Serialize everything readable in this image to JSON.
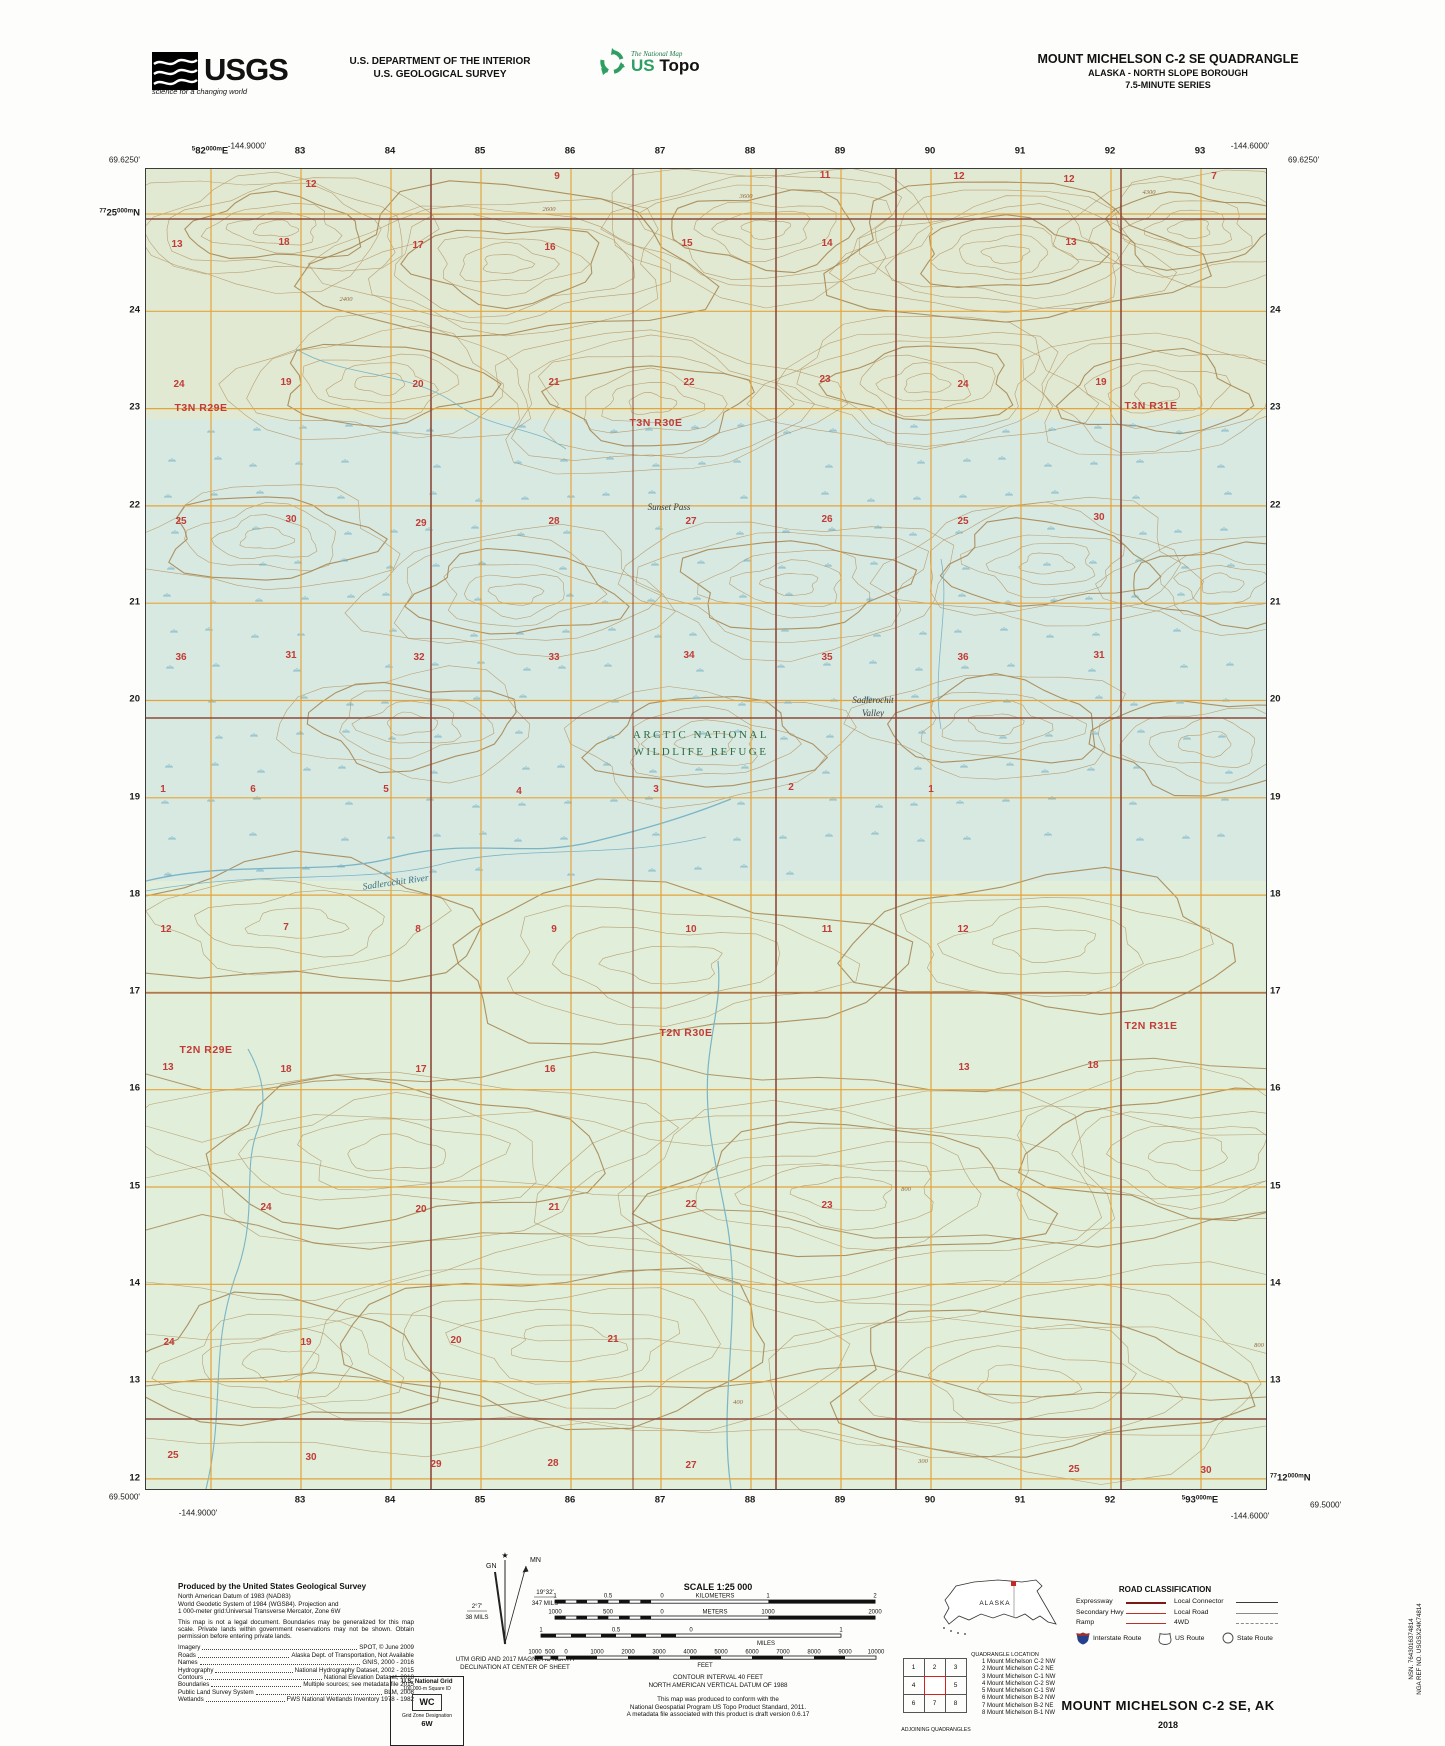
{
  "header": {
    "agency": "USGS",
    "agency_tagline": "science for a changing world",
    "dept_line1": "U.S. DEPARTMENT OF THE INTERIOR",
    "dept_line2": "U.S. GEOLOGICAL SURVEY",
    "program_small": "The National Map",
    "program_us": "US",
    "program_topo": "Topo",
    "quad_title": "MOUNT MICHELSON C-2 SE QUADRANGLE",
    "quad_subtitle": "ALASKA - NORTH SLOPE BOROUGH",
    "quad_series": "7.5-MINUTE SERIES"
  },
  "map": {
    "corner_coords": [
      {
        "t": "-144.9000'",
        "x": 247,
        "y": 146,
        "a": "c"
      },
      {
        "t": "69.6250'",
        "x": 140,
        "y": 160,
        "a": "r"
      },
      {
        "t": "-144.6000'",
        "x": 1250,
        "y": 146,
        "a": "c"
      },
      {
        "t": "69.6250'",
        "x": 1288,
        "y": 160,
        "a": "l"
      },
      {
        "t": "69.5000'",
        "x": 140,
        "y": 1497,
        "a": "r"
      },
      {
        "t": "-144.9000'",
        "x": 198,
        "y": 1513,
        "a": "c"
      },
      {
        "t": "-144.6000'",
        "x": 1250,
        "y": 1516,
        "a": "c"
      },
      {
        "t": "69.5000'",
        "x": 1310,
        "y": 1505,
        "a": "l"
      }
    ],
    "grid_full_labels": [
      {
        "x": 210,
        "y": 151,
        "pos": "c",
        "parts": [
          [
            "5",
            1
          ],
          [
            "82",
            0
          ],
          [
            "000m",
            1
          ],
          [
            "E",
            0
          ]
        ]
      },
      {
        "x": 140,
        "y": 213,
        "pos": "r",
        "parts": [
          [
            "77",
            1
          ],
          [
            "25",
            0
          ],
          [
            "000m",
            1
          ],
          [
            "N",
            0
          ]
        ]
      },
      {
        "x": 1200,
        "y": 1500,
        "pos": "c",
        "parts": [
          [
            "5",
            1
          ],
          [
            "93",
            0
          ],
          [
            "000m",
            1
          ],
          [
            "E",
            0
          ]
        ]
      },
      {
        "x": 1270,
        "y": 1478,
        "pos": "l",
        "parts": [
          [
            "77",
            1
          ],
          [
            "12",
            0
          ],
          [
            "000m",
            1
          ],
          [
            "N",
            0
          ]
        ]
      }
    ],
    "grid_top": [
      "83",
      "84",
      "85",
      "86",
      "87",
      "88",
      "89",
      "90",
      "91",
      "92",
      "93"
    ],
    "grid_bottom": [
      "83",
      "84",
      "85",
      "86",
      "87",
      "88",
      "89",
      "90",
      "91",
      "92"
    ],
    "grid_left": [
      "24",
      "23",
      "22",
      "21",
      "20",
      "19",
      "18",
      "17",
      "16",
      "15",
      "14",
      "13",
      "12"
    ],
    "grid_right": [
      "24",
      "23",
      "22",
      "21",
      "20",
      "19",
      "18",
      "17",
      "16",
      "15",
      "14",
      "13"
    ],
    "townships": [
      {
        "t": "T3N R29E",
        "x": 200,
        "y": 410
      },
      {
        "t": "T3N R30E",
        "x": 655,
        "y": 425
      },
      {
        "t": "T3N R31E",
        "x": 1150,
        "y": 408
      },
      {
        "t": "T2N R29E",
        "x": 205,
        "y": 1052
      },
      {
        "t": "T2N R30E",
        "x": 685,
        "y": 1035
      },
      {
        "t": "T2N R31E",
        "x": 1150,
        "y": 1028
      }
    ],
    "area_labels": {
      "refuge1": "ARCTIC NATIONAL",
      "refuge2": "WILDLIFE REFUGE",
      "pass": "Sunset Pass",
      "valley1": "Sadlerochit",
      "valley2": "Valley",
      "river": "Sadlerochit River"
    },
    "sections": [
      [
        310,
        186,
        "12"
      ],
      [
        556,
        178,
        "9"
      ],
      [
        824,
        177,
        "11"
      ],
      [
        958,
        178,
        "12"
      ],
      [
        1068,
        181,
        "12"
      ],
      [
        1213,
        178,
        "7"
      ],
      [
        176,
        246,
        "13"
      ],
      [
        283,
        244,
        "18"
      ],
      [
        417,
        247,
        "17"
      ],
      [
        549,
        249,
        "16"
      ],
      [
        686,
        245,
        "15"
      ],
      [
        826,
        245,
        "14"
      ],
      [
        1070,
        244,
        "13"
      ],
      [
        178,
        386,
        "24"
      ],
      [
        285,
        384,
        "19"
      ],
      [
        417,
        386,
        "20"
      ],
      [
        553,
        384,
        "21"
      ],
      [
        688,
        384,
        "22"
      ],
      [
        824,
        381,
        "23"
      ],
      [
        962,
        386,
        "24"
      ],
      [
        1100,
        384,
        "19"
      ],
      [
        180,
        523,
        "25"
      ],
      [
        290,
        521,
        "30"
      ],
      [
        420,
        525,
        "29"
      ],
      [
        553,
        523,
        "28"
      ],
      [
        690,
        523,
        "27"
      ],
      [
        826,
        521,
        "26"
      ],
      [
        962,
        523,
        "25"
      ],
      [
        1098,
        519,
        "30"
      ],
      [
        180,
        659,
        "36"
      ],
      [
        290,
        657,
        "31"
      ],
      [
        418,
        659,
        "32"
      ],
      [
        553,
        659,
        "33"
      ],
      [
        688,
        657,
        "34"
      ],
      [
        826,
        659,
        "35"
      ],
      [
        962,
        659,
        "36"
      ],
      [
        1098,
        657,
        "31"
      ],
      [
        162,
        791,
        "1"
      ],
      [
        252,
        791,
        "6"
      ],
      [
        385,
        791,
        "5"
      ],
      [
        518,
        793,
        "4"
      ],
      [
        655,
        791,
        "3"
      ],
      [
        790,
        789,
        "2"
      ],
      [
        930,
        791,
        "1"
      ],
      [
        165,
        931,
        "12"
      ],
      [
        285,
        929,
        "7"
      ],
      [
        417,
        931,
        "8"
      ],
      [
        553,
        931,
        "9"
      ],
      [
        690,
        931,
        "10"
      ],
      [
        826,
        931,
        "11"
      ],
      [
        962,
        931,
        "12"
      ],
      [
        167,
        1069,
        "13"
      ],
      [
        285,
        1071,
        "18"
      ],
      [
        420,
        1071,
        "17"
      ],
      [
        549,
        1071,
        "16"
      ],
      [
        963,
        1069,
        "13"
      ],
      [
        1092,
        1067,
        "18"
      ],
      [
        265,
        1209,
        "24"
      ],
      [
        420,
        1211,
        "20"
      ],
      [
        553,
        1209,
        "21"
      ],
      [
        690,
        1206,
        "22"
      ],
      [
        826,
        1207,
        "23"
      ],
      [
        168,
        1344,
        "24"
      ],
      [
        305,
        1344,
        "19"
      ],
      [
        455,
        1342,
        "20"
      ],
      [
        612,
        1341,
        "21"
      ],
      [
        172,
        1457,
        "25"
      ],
      [
        310,
        1459,
        "30"
      ],
      [
        435,
        1466,
        "29"
      ],
      [
        552,
        1465,
        "28"
      ],
      [
        690,
        1467,
        "27"
      ],
      [
        1073,
        1471,
        "25"
      ],
      [
        1205,
        1472,
        "30"
      ]
    ],
    "elevations": [
      [
        548,
        210,
        "2600"
      ],
      [
        745,
        197,
        "3600"
      ],
      [
        345,
        300,
        "2400"
      ],
      [
        1148,
        193,
        "4300"
      ],
      [
        905,
        1190,
        "800"
      ],
      [
        737,
        1403,
        "400"
      ],
      [
        922,
        1462,
        "300"
      ],
      [
        1258,
        1346,
        "800"
      ]
    ]
  },
  "footer": {
    "produced": {
      "heading": "Produced by the United States Geological Survey",
      "datum_lines": [
        "North American Datum of 1983 (NAD83)",
        "World Geodetic System of 1984 (WGS84).  Projection and",
        "1 000-meter grid:Universal Transverse Mercator, Zone 6W"
      ],
      "legal": "This map is not a legal document. Boundaries may be generalized for this map scale. Private lands within government reservations may not be shown. Obtain permission before entering private lands.",
      "credits": [
        [
          "Imagery",
          "SPOT,  ©  June  2009"
        ],
        [
          "Roads",
          "Alaska Dept. of Transportation, Not Available"
        ],
        [
          "Names",
          "GNIS, 2000 - 2016"
        ],
        [
          "Hydrography",
          "National Hydrography Dataset, 2002 - 2015"
        ],
        [
          "Contours",
          "National Elevation Dataset, 2018"
        ],
        [
          "Boundaries",
          "Multiple sources; see metadata file 2015"
        ],
        [
          "Public Land Survey System",
          "BLM, 2008"
        ],
        [
          "Wetlands",
          "FWS National Wetlands Inventory 1978 - 1982"
        ]
      ]
    },
    "declination": {
      "gn": "GN",
      "mn": "MN",
      "mn_deg": "19°32'",
      "mn_mils": "347 MILS",
      "gn_deg": "2°7'",
      "gn_mils": "38 MILS",
      "cap1": "UTM GRID AND 2017 MAGNETIC NORTH",
      "cap2": "DECLINATION AT CENTER OF SHEET"
    },
    "usng": {
      "title": "U.S. National Grid",
      "sq_label": "100,000-m Square ID",
      "square": "WC",
      "zone_label": "Grid Zone Designation",
      "zone": "6W"
    },
    "scale": {
      "title": "SCALE 1:25 000",
      "bars": [
        {
          "y": 10,
          "x": 60,
          "unit": 106.7,
          "subdiv": 10,
          "right": 2,
          "labels": [
            [
              "1",
              60
            ],
            [
              "0.5",
              113
            ],
            [
              "0",
              167
            ],
            [
              "KILOMETERS",
              220
            ],
            [
              "1",
              273
            ],
            [
              "2",
              380
            ]
          ]
        },
        {
          "y": 26,
          "x": 60,
          "unit": 106.7,
          "subdiv": 10,
          "right": 2,
          "labels": [
            [
              "1000",
              60
            ],
            [
              "500",
              113
            ],
            [
              "0",
              167
            ],
            [
              "METERS",
              220
            ],
            [
              "1000",
              273
            ],
            [
              "2000",
              380
            ]
          ]
        },
        {
          "y": 44,
          "x": 46,
          "unit": 150,
          "subdiv": 10,
          "right": 1,
          "labels": [
            [
              "1",
              46
            ],
            [
              "0.5",
              121
            ],
            [
              "0",
              196
            ],
            [
              "1",
              346
            ]
          ],
          "below": [
            "MILES",
            271
          ]
        },
        {
          "y": 66,
          "x": 40,
          "unit": 31,
          "subdiv": 4,
          "right": 10,
          "labels": [
            [
              "1000",
              40
            ],
            [
              "500",
              55
            ],
            [
              "0",
              71
            ],
            [
              "1000",
              102
            ],
            [
              "2000",
              133
            ],
            [
              "3000",
              164
            ],
            [
              "4000",
              195
            ],
            [
              "5000",
              226
            ],
            [
              "6000",
              257
            ],
            [
              "7000",
              288
            ],
            [
              "8000",
              319
            ],
            [
              "9000",
              350
            ],
            [
              "10000",
              381
            ]
          ],
          "below": [
            "FEET",
            210
          ]
        }
      ],
      "note1": "CONTOUR INTERVAL 40 FEET",
      "note2": "NORTH AMERICAN VERTICAL DATUM OF 1988",
      "conform": [
        "This map was produced to conform with the",
        "National Geospatial Program US Topo Product Standard, 2011.",
        "A metadata file associated with this product is draft version 0.6.17"
      ]
    },
    "inset": {
      "state": "ALASKA",
      "caption": "QUADRANGLE LOCATION"
    },
    "roads": {
      "title": "ROAD CLASSIFICATION",
      "rows": [
        {
          "l": "Expressway",
          "lw": 2.6,
          "lc": "#7a1a15",
          "r": "Local Connector",
          "rw": 1.4,
          "rc": "#3a3a3a",
          "rdash": 0
        },
        {
          "l": "Secondary Hwy",
          "lw": 1.6,
          "lc": "#b5332a",
          "r": "Local Road",
          "rw": 1.4,
          "rc": "#8a8a8a",
          "rdash": 0
        },
        {
          "l": "Ramp",
          "lw": 1,
          "lc": "#b5332a",
          "r": "4WD",
          "rw": 1,
          "rc": "#8a8a8a",
          "rdash": 1
        }
      ],
      "shields": [
        "Interstate Route",
        "US Route",
        "State Route"
      ]
    },
    "adjoining": {
      "cells": [
        "1",
        "2",
        "3",
        "4",
        "",
        "5",
        "6",
        "7",
        "8"
      ],
      "caption": "ADJOINING QUADRANGLES",
      "list": [
        "1 Mount Michelson C-2 NW",
        "2 Mount Michelson C-2 NE",
        "3 Mount Michelson C-1 NW",
        "4 Mount Michelson C-2 SW",
        "5 Mount Michelson C-1 SW",
        "6 Mount Michelson B-2 NW",
        "7 Mount Michelson B-2 NE",
        "8 Mount Michelson B-1 NW"
      ]
    },
    "title_block": {
      "title": "MOUNT MICHELSON C-2 SE,  AK",
      "year": "2018"
    },
    "nsn": {
      "line1": "NSN. 7643016374814",
      "line2": "NGA REF NO. USGSX24K74814"
    }
  }
}
